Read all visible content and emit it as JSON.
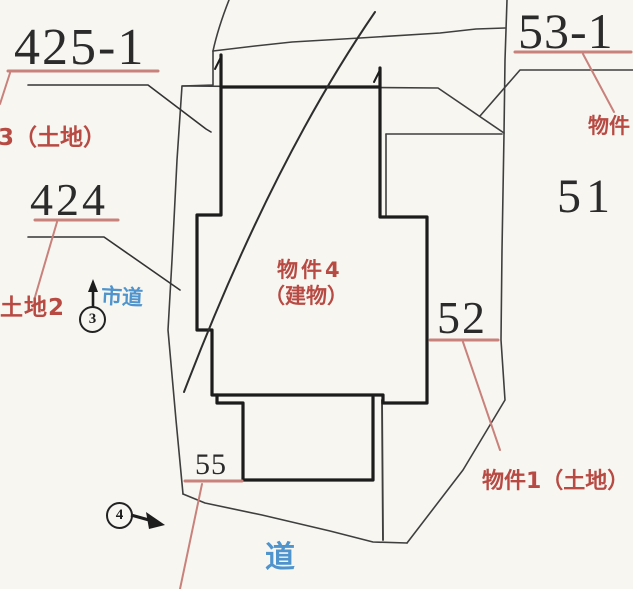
{
  "colors": {
    "paper": "#f8f6f1",
    "ink": "#2b2b2b",
    "boundary_line": "#3f3f3f",
    "building_line": "#1c1c1c",
    "red_text": "#b84a44",
    "red_line": "#c9817c",
    "blue_text": "#4f94cd"
  },
  "parcels": {
    "lot425": {
      "number": "425-1",
      "note": "3（土地）"
    },
    "lot424": {
      "number": "424",
      "note": "土地2"
    },
    "lot53": {
      "number": "53-1",
      "note": "物件"
    },
    "lot51": {
      "number": "51"
    },
    "lot52": {
      "number": "52",
      "note": "物件1（土地）"
    },
    "lot55": {
      "number": "55"
    }
  },
  "building": {
    "line1": "物件4",
    "line2": "（建物）"
  },
  "roads": {
    "city_road": "市道",
    "road": "道"
  },
  "points": {
    "p3": "3",
    "p4": "4"
  }
}
